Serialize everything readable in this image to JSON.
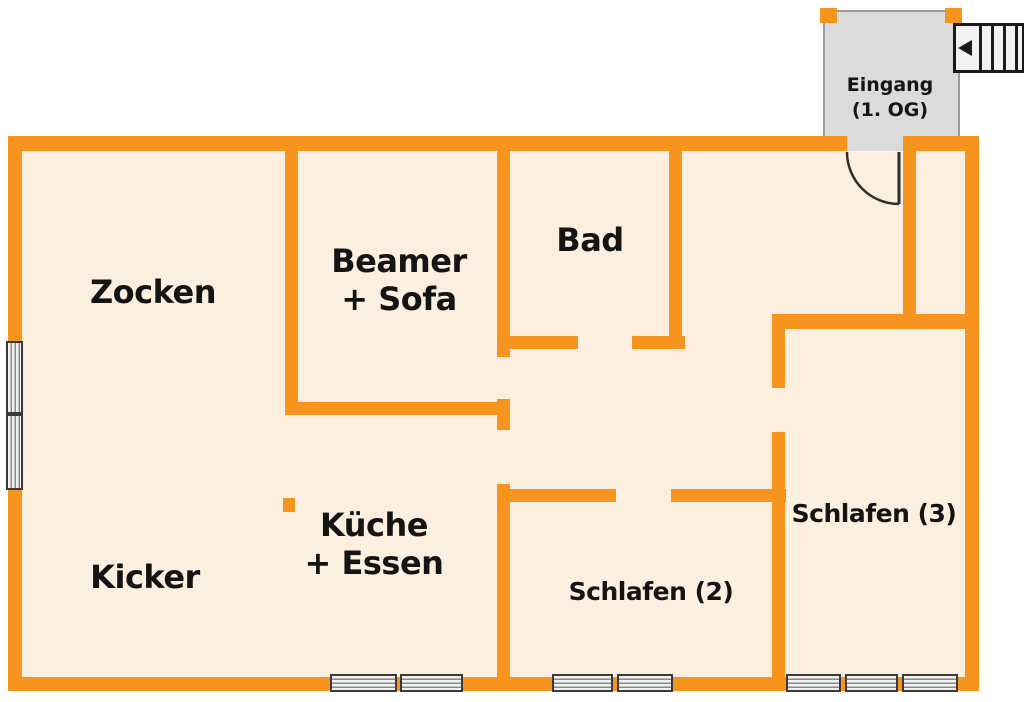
{
  "floorplan": {
    "rooms": {
      "zocken": {
        "label": "Zocken"
      },
      "beamer_sofa": {
        "line1": "Beamer",
        "line2": "+ Sofa"
      },
      "bad": {
        "label": "Bad"
      },
      "kicker": {
        "label": "Kicker"
      },
      "kueche_essen": {
        "line1": "Küche",
        "line2": "+ Essen"
      },
      "schlafen2": {
        "label": "Schlafen (2)"
      },
      "schlafen3": {
        "label": "Schlafen (3)"
      },
      "eingang": {
        "line1": "Eingang",
        "line2": "(1. OG)"
      }
    },
    "stairs": {
      "direction": "left"
    },
    "colors": {
      "wall": "#F7941D",
      "floor": "#FCEFDF",
      "entry_fill": "#DBDBDB",
      "entry_border": "#9B9B9B",
      "window_fill": "#F2F2F2",
      "window_line": "#8A8A8A",
      "window_border": "#3A3A3A",
      "door_line": "#2E2E2E",
      "stairs_line": "#1A1A1A",
      "label_text": "#141414",
      "background": "#FFFFFF"
    }
  }
}
